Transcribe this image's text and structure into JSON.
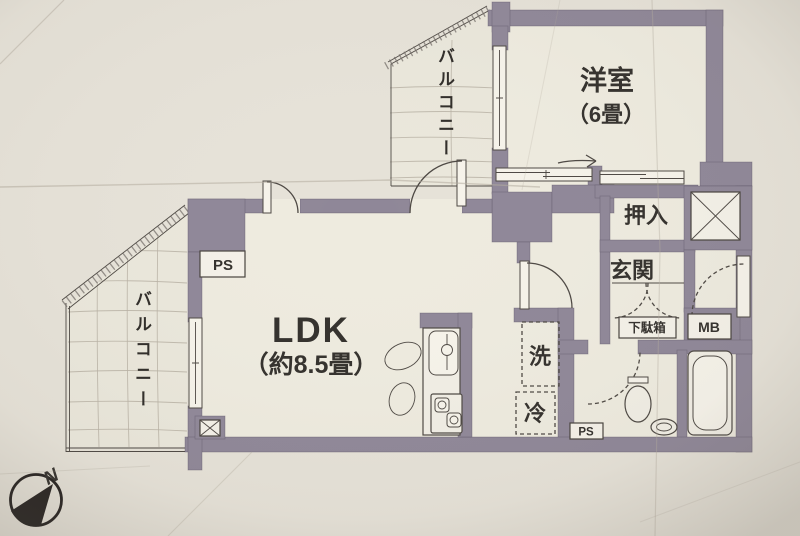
{
  "plan": {
    "western_room": {
      "label": "洋室",
      "size": "（6畳）"
    },
    "ldk": {
      "label": "LDK",
      "size": "（約8.5畳）"
    },
    "balcony_north": {
      "label": "バルコニー"
    },
    "balcony_west": {
      "label": "バルコニー"
    },
    "closet": {
      "label": "押入"
    },
    "entrance": {
      "label": "玄関"
    },
    "shoe_cabinet": {
      "label": "下駄箱"
    },
    "meter_box": {
      "label": "MB"
    },
    "washing_machine": {
      "label": "洗"
    },
    "refrigerator": {
      "label": "冷"
    },
    "pipe_space_nw": {
      "label": "PS"
    },
    "pipe_space_se": {
      "label": "PS"
    },
    "compass": {
      "label": "N"
    }
  },
  "colors": {
    "wall": "#8f8798",
    "paper": "#e6e2d8",
    "floor": "#eeebdf",
    "ink": "#33302c",
    "line": "#4d4843"
  }
}
